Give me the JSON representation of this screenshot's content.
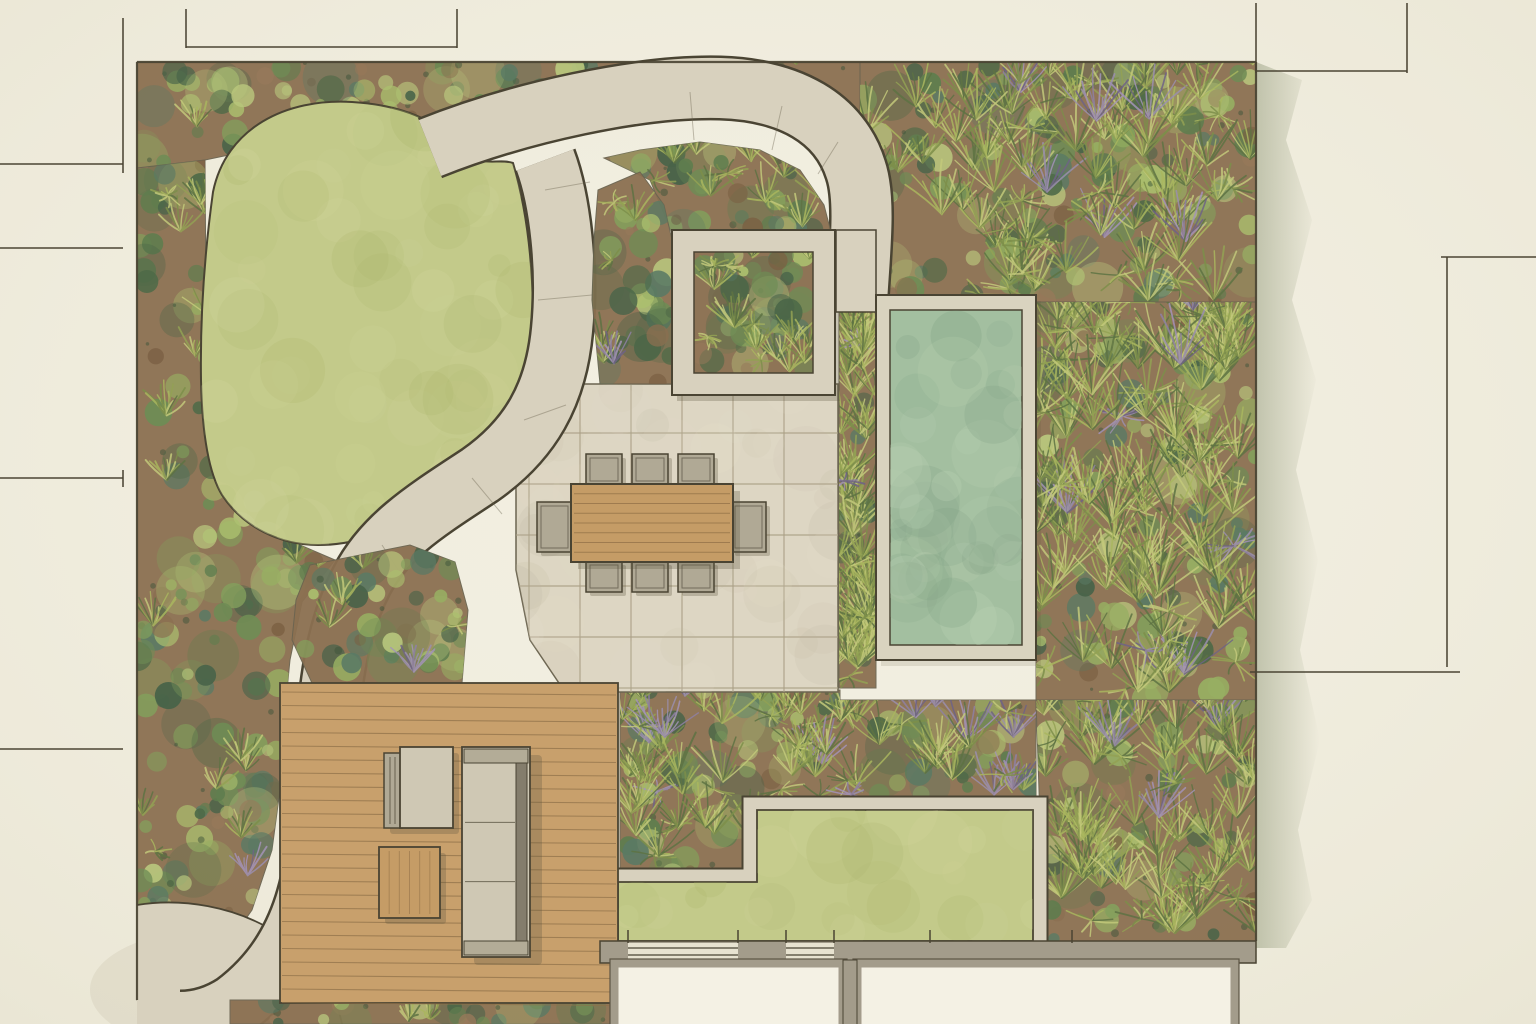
{
  "document": {
    "type": "garden-landscape-plan",
    "style": "watercolor plan view",
    "visible_text": ""
  },
  "canvas": {
    "w": 1536,
    "h": 1024
  },
  "colors": {
    "paper": "#f2efe1",
    "paperEdge": "#e9e5d3",
    "pen": "#4a4433",
    "penSoft": "#6b6450",
    "soil": "#8b7051",
    "soilDark": "#74593f",
    "lawn": "#c3ca8a",
    "lawnDark": "#aab569",
    "lawnLight": "#d4d8a0",
    "stone": "#d8d1be",
    "stoneDark": "#b9b09a",
    "stoneLight": "#e7e0cd",
    "grout": "#a89d83",
    "tile": "#ddd6c3",
    "wood": "#c59c66",
    "woodLine": "#96744a",
    "deck": "#c8a06c",
    "deckLine": "#8f7149",
    "water": "#a3bfa0",
    "waterLight": "#bcd2b4",
    "waterDark": "#84a487",
    "coping": "#d9d3bf",
    "wall": "#a39c8b",
    "interior": "#f4f1e4",
    "opening": "#e7e2d0",
    "cushion": "#cfc8b4",
    "cushionDark": "#b3ac97",
    "chair": "#b0a995",
    "chairDark": "#847d6c",
    "shadow": "rgba(90,82,60,0.28)",
    "speckle": "#3d5439",
    "washOutside": "#9aa183",
    "foliage": [
      "#4f6a48",
      "#5f7d4e",
      "#6f8c55",
      "#83a05c",
      "#97ae62",
      "#abbf6e",
      "#5a7a64",
      "#486349",
      "#b9c77d"
    ],
    "brown": [
      "#8a6f50",
      "#7a5f42",
      "#97795a"
    ],
    "grass": [
      "#7d8f4a",
      "#93a254",
      "#aab75f",
      "#5e7343",
      "#c3c97b"
    ],
    "purple": [
      "#8f80a4",
      "#a493b8",
      "#6f6386",
      "#9b8fae"
    ]
  },
  "beds_under": [
    {
      "name": "hedge-north",
      "pts": [
        [
          137,
          62
        ],
        [
          860,
          62
        ],
        [
          860,
          150
        ],
        [
          700,
          86
        ],
        [
          560,
          120
        ],
        [
          430,
          130
        ],
        [
          300,
          140
        ],
        [
          205,
          160
        ],
        [
          137,
          168
        ]
      ],
      "density": 0.0022,
      "tufts": 8e-05,
      "tuftLen": 26,
      "purple": 0.01
    },
    {
      "name": "bed-northeast",
      "pts": [
        [
          860,
          62
        ],
        [
          1256,
          62
        ],
        [
          1256,
          302
        ],
        [
          1044,
          302
        ],
        [
          876,
          296
        ],
        [
          876,
          150
        ],
        [
          860,
          120
        ]
      ],
      "density": 0.0016,
      "tufts": 0.0009,
      "tuftLen": 46,
      "purple": 0.1
    },
    {
      "name": "bed-west",
      "pts": [
        [
          137,
          168
        ],
        [
          205,
          160
        ],
        [
          206,
          300
        ],
        [
          206,
          420
        ],
        [
          218,
          468
        ],
        [
          252,
          512
        ],
        [
          300,
          545
        ],
        [
          335,
          560
        ],
        [
          302,
          602
        ],
        [
          290,
          660
        ],
        [
          284,
          720
        ],
        [
          280,
          790
        ],
        [
          272,
          850
        ],
        [
          252,
          910
        ],
        [
          214,
          964
        ],
        [
          163,
          1000
        ],
        [
          137,
          1000
        ]
      ],
      "density": 0.0018,
      "tufts": 0.0002,
      "tuftLen": 30,
      "purple": 0.05
    },
    {
      "name": "bed-east",
      "pts": [
        [
          1036,
          302
        ],
        [
          1256,
          302
        ],
        [
          1256,
          700
        ],
        [
          1036,
          700
        ]
      ],
      "density": 0.0014,
      "tufts": 0.0013,
      "tuftLen": 52,
      "purple": 0.07
    },
    {
      "name": "bed-south-mid",
      "pts": [
        [
          620,
          690
        ],
        [
          840,
          690
        ],
        [
          840,
          700
        ],
        [
          1036,
          700
        ],
        [
          1036,
          798
        ],
        [
          757,
          798
        ],
        [
          757,
          884
        ],
        [
          620,
          884
        ]
      ],
      "density": 0.0017,
      "tufts": 0.0013,
      "tuftLen": 40,
      "purple": 0.14
    },
    {
      "name": "bed-southeast",
      "pts": [
        [
          1036,
          700
        ],
        [
          1256,
          700
        ],
        [
          1256,
          941
        ],
        [
          1044,
          941
        ]
      ],
      "density": 0.0014,
      "tufts": 0.0012,
      "tuftLen": 46,
      "purple": 0.05
    }
  ],
  "beds_over": [
    {
      "name": "bed-above-planter",
      "pts": [
        [
          604,
          158
        ],
        [
          640,
          150
        ],
        [
          700,
          142
        ],
        [
          760,
          150
        ],
        [
          800,
          170
        ],
        [
          824,
          205
        ],
        [
          832,
          236
        ],
        [
          672,
          233
        ],
        [
          650,
          180
        ]
      ],
      "density": 0.0024,
      "tufts": 0.0008,
      "tuftLen": 34,
      "purple": 0.03
    },
    {
      "name": "bed-path-planter",
      "pts": [
        [
          598,
          190
        ],
        [
          640,
          172
        ],
        [
          664,
          205
        ],
        [
          672,
          240
        ],
        [
          672,
          384
        ],
        [
          600,
          384
        ],
        [
          592,
          300
        ],
        [
          594,
          240
        ]
      ],
      "density": 0.0024,
      "tufts": 0.0004,
      "tuftLen": 30,
      "purple": 0.06
    },
    {
      "name": "bed-path-deck",
      "pts": [
        [
          310,
          565
        ],
        [
          410,
          545
        ],
        [
          455,
          562
        ],
        [
          468,
          610
        ],
        [
          462,
          683
        ],
        [
          312,
          683
        ],
        [
          292,
          640
        ],
        [
          296,
          600
        ]
      ],
      "density": 0.0024,
      "tufts": 0.0003,
      "tuftLen": 28,
      "purple": 0.08
    },
    {
      "name": "grass-pool-west",
      "pts": [
        [
          839,
          312
        ],
        [
          876,
          312
        ],
        [
          876,
          688
        ],
        [
          839,
          688
        ]
      ],
      "density": 0.0009,
      "tufts": 0.0045,
      "tuftLen": 42,
      "purple": 0.02
    },
    {
      "name": "hedge-south",
      "pts": [
        [
          230,
          1000
        ],
        [
          616,
          1000
        ],
        [
          616,
          1024
        ],
        [
          230,
          1024
        ]
      ],
      "density": 0.003,
      "tufts": 0.0002,
      "tuftLen": 18,
      "purple": 0.0
    }
  ],
  "planter_bed": {
    "name": "raised-planter-bed",
    "pts": [
      [
        694,
        252
      ],
      [
        813,
        252
      ],
      [
        813,
        373
      ],
      [
        694,
        373
      ]
    ],
    "density": 0.0038,
    "tufts": 0.0012,
    "tuftLen": 30,
    "purple": 0.04
  },
  "north_lawn": {
    "d": "M 213,192 C 226,128 286,98 352,102 C 416,106 444,128 466,152 C 482,168 498,158 513,163 C 524,200 532,250 533,310 C 533,360 524,405 505,440 C 486,472 452,492 415,515 C 383,535 352,545 318,545 C 280,545 243,527 222,495 C 208,472 202,430 201,380 C 200,315 205,250 213,192 Z",
    "mottle": 70
  },
  "pathway": {
    "width": 60,
    "arc": "M 430,148 C 520,112 640,86 720,88 C 790,90 840,118 856,170 C 866,200 860,250 857,302",
    "stem": "M 545,160 C 560,200 568,270 562,330 C 556,395 530,440 480,475 C 430,508 385,535 362,580 C 340,622 332,670 328,720 C 324,775 322,830 312,880 C 300,935 275,975 235,1005 C 215,1018 195,1022 180,1022",
    "corner": "M 137,905 C 180,898 235,905 280,935 C 315,958 335,990 342,1024 L 137,1024 Z",
    "corner_edge": "M 137,905 C 180,898 235,905 280,935 C 315,958 335,990 342,1024",
    "joints": [
      [
        545,
        190,
        590,
        182
      ],
      [
        538,
        300,
        592,
        295
      ],
      [
        524,
        420,
        566,
        405
      ],
      [
        472,
        478,
        502,
        514
      ],
      [
        382,
        545,
        406,
        582
      ],
      [
        340,
        650,
        366,
        654
      ],
      [
        330,
        770,
        354,
        768
      ],
      [
        302,
        900,
        330,
        890
      ],
      [
        690,
        92,
        694,
        140
      ],
      [
        782,
        106,
        772,
        150
      ],
      [
        838,
        142,
        818,
        174
      ]
    ]
  },
  "patio": {
    "pts": [
      [
        522,
        384
      ],
      [
        838,
        384
      ],
      [
        838,
        692
      ],
      [
        565,
        692
      ],
      [
        530,
        640
      ],
      [
        516,
        570
      ],
      [
        516,
        480
      ],
      [
        522,
        430
      ]
    ],
    "grid_x": [
      529,
      580,
      631,
      682,
      733,
      784
    ],
    "grid_y": [
      433,
      484,
      535,
      586,
      637,
      688
    ],
    "mottle": 55
  },
  "planter": {
    "outer": [
      672,
      230,
      163,
      165
    ],
    "inner": [
      694,
      252,
      119,
      121
    ]
  },
  "wall_connector": [
    836,
    230,
    40,
    82
  ],
  "pool": {
    "coping": [
      876,
      295,
      160,
      365
    ],
    "water": [
      890,
      310,
      132,
      335
    ],
    "mottle": 45
  },
  "south_lawn": {
    "surface": [
      [
        618,
        882
      ],
      [
        757,
        882
      ],
      [
        757,
        810
      ],
      [
        1033,
        810
      ],
      [
        1033,
        941
      ],
      [
        618,
        941
      ]
    ],
    "edging": "M 612,876 L 750,876 L 750,804 L 1040,804 L 1040,941",
    "mottle": 30
  },
  "deck": {
    "rect": [
      280,
      683,
      338,
      320
    ],
    "plank_step": 13.5
  },
  "dining": {
    "table": [
      571,
      484,
      162,
      78
    ],
    "table_lines": 7,
    "chairs": [
      {
        "x": 586,
        "y": 454,
        "w": 36,
        "h": 31,
        "side": "top"
      },
      {
        "x": 632,
        "y": 454,
        "w": 36,
        "h": 31,
        "side": "top"
      },
      {
        "x": 678,
        "y": 454,
        "w": 36,
        "h": 31,
        "side": "top"
      },
      {
        "x": 586,
        "y": 561,
        "w": 36,
        "h": 31,
        "side": "bottom"
      },
      {
        "x": 632,
        "y": 561,
        "w": 36,
        "h": 31,
        "side": "bottom"
      },
      {
        "x": 678,
        "y": 561,
        "w": 36,
        "h": 31,
        "side": "bottom"
      },
      {
        "x": 537,
        "y": 502,
        "w": 35,
        "h": 50,
        "side": "left"
      },
      {
        "x": 731,
        "y": 502,
        "w": 35,
        "h": 50,
        "side": "right"
      }
    ]
  },
  "lounge_set": {
    "sofa": [
      462,
      747,
      68,
      210
    ],
    "lounge_chair": [
      384,
      747,
      69,
      81
    ],
    "coffee_table": [
      379,
      847,
      61,
      71
    ],
    "coffee_grain": 5
  },
  "house": {
    "wall_band": [
      600,
      941,
      656,
      22
    ],
    "openings": [
      {
        "x": 628,
        "w": 110
      },
      {
        "x": 786,
        "w": 48
      }
    ],
    "ticks": [
      628,
      738,
      786,
      834,
      930,
      1072
    ],
    "rooms": [
      [
        614,
        963,
        229,
        80
      ],
      [
        857,
        963,
        378,
        80
      ]
    ],
    "divider": [
      843,
      960,
      14,
      70
    ]
  },
  "boundary": [
    [
      137,
      62,
      137,
      1000
    ],
    [
      137,
      62,
      1256,
      62
    ],
    [
      1256,
      62,
      1256,
      941
    ]
  ],
  "dimension_lines": [
    [
      123,
      18,
      123,
      173
    ],
    [
      186,
      9,
      186,
      48
    ],
    [
      186,
      47,
      457,
      47
    ],
    [
      457,
      9,
      457,
      48
    ],
    [
      0,
      164,
      123,
      164
    ],
    [
      0,
      248,
      123,
      248
    ],
    [
      0,
      478,
      123,
      478
    ],
    [
      123,
      470,
      123,
      487
    ],
    [
      0,
      749,
      123,
      749
    ],
    [
      1256,
      3,
      1256,
      73
    ],
    [
      1256,
      71,
      1407,
      71
    ],
    [
      1407,
      3,
      1407,
      73
    ],
    [
      1441,
      257,
      1536,
      257
    ],
    [
      1447,
      257,
      1447,
      667
    ],
    [
      1250,
      672,
      1460,
      672
    ]
  ],
  "wash_right": {
    "pts": [
      [
        1256,
        62
      ],
      [
        1302,
        80
      ],
      [
        1286,
        140
      ],
      [
        1312,
        220
      ],
      [
        1292,
        300
      ],
      [
        1316,
        380
      ],
      [
        1296,
        470
      ],
      [
        1318,
        560
      ],
      [
        1300,
        650
      ],
      [
        1320,
        740
      ],
      [
        1298,
        830
      ],
      [
        1312,
        900
      ],
      [
        1286,
        948
      ],
      [
        1256,
        948
      ]
    ]
  },
  "wash_bottom_left": {
    "cx": 210,
    "cy": 990,
    "rx": 120,
    "ry": 60
  }
}
